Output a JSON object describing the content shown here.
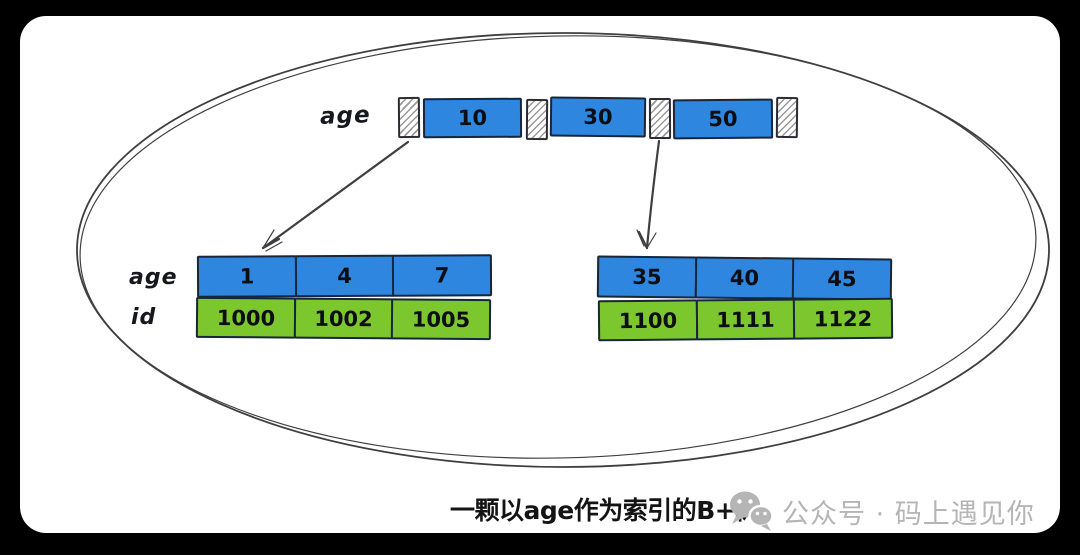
{
  "colors": {
    "background": "#000000",
    "canvas": "#ffffff",
    "key_blue": "#2E86DE",
    "id_green": "#7CC62E",
    "cell_border": "#16263C",
    "sketch_stroke": "#3F3F3F",
    "watermark_gray": "#B5B5B5"
  },
  "root": {
    "label": "age",
    "keys": [
      "10",
      "30",
      "50"
    ]
  },
  "leaves": {
    "left": {
      "age_label": "age",
      "id_label": "id",
      "ages": [
        "1",
        "4",
        "7"
      ],
      "ids": [
        "1000",
        "1002",
        "1005"
      ]
    },
    "right": {
      "ages": [
        "35",
        "40",
        "45"
      ],
      "ids": [
        "1100",
        "1111",
        "1122"
      ]
    }
  },
  "caption": {
    "title": "一颗以age作为索引的B+树",
    "watermark_icon": "wechat-icon",
    "watermark_text": "公众号 · 码上遇见你"
  }
}
